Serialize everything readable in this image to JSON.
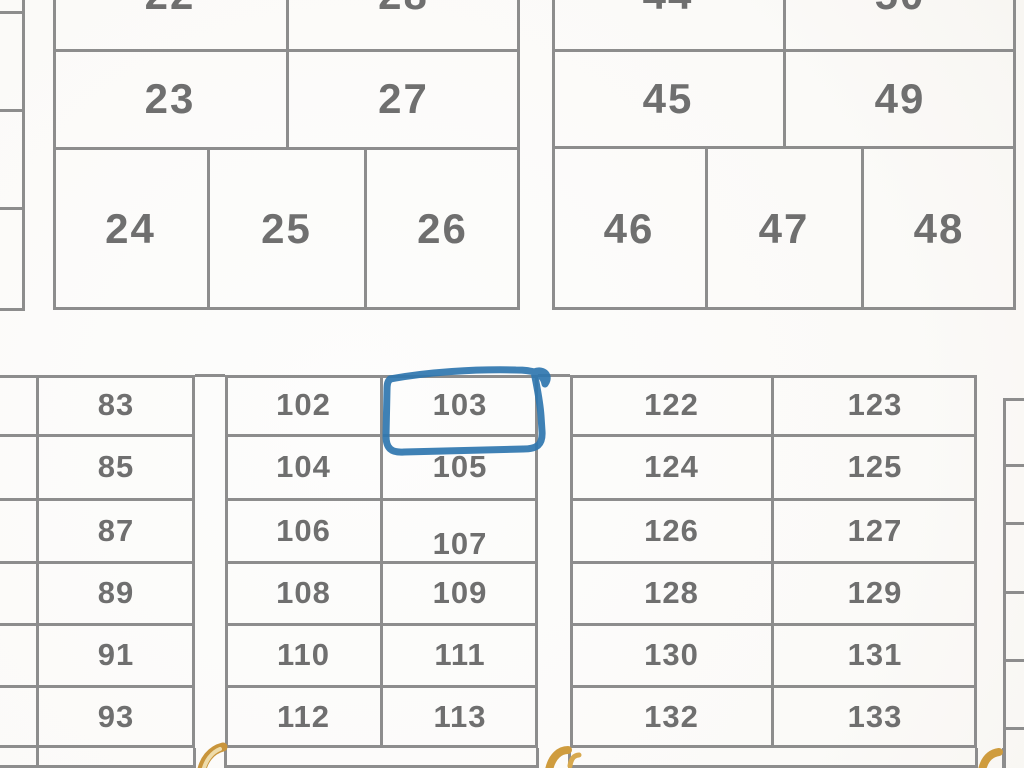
{
  "map": {
    "highlighted_plot": "103",
    "colors": {
      "grid_line": "#8d8d8d",
      "plot_number": "#6f6f6f",
      "highlight_ink": "#2f76af",
      "street_label_ink": "#c9953b",
      "background": "#fbfaf8"
    },
    "plots": {
      "p22": "22",
      "p23": "23",
      "p24": "24",
      "p25": "25",
      "p26": "26",
      "p27": "27",
      "p28": "28",
      "p44": "44",
      "p45": "45",
      "p46": "46",
      "p47": "47",
      "p48": "48",
      "p49": "49",
      "p50": "50",
      "p83": "83",
      "p85": "85",
      "p87": "87",
      "p89": "89",
      "p91": "91",
      "p93": "93",
      "p102": "102",
      "p103": "103",
      "p104": "104",
      "p105": "105",
      "p106": "106",
      "p107": "107",
      "p108": "108",
      "p109": "109",
      "p110": "110",
      "p111": "111",
      "p112": "112",
      "p113": "113",
      "p122": "122",
      "p123": "123",
      "p124": "124",
      "p125": "125",
      "p126": "126",
      "p127": "127",
      "p128": "128",
      "p129": "129",
      "p130": "130",
      "p131": "131",
      "p132": "132",
      "p133": "133"
    }
  }
}
